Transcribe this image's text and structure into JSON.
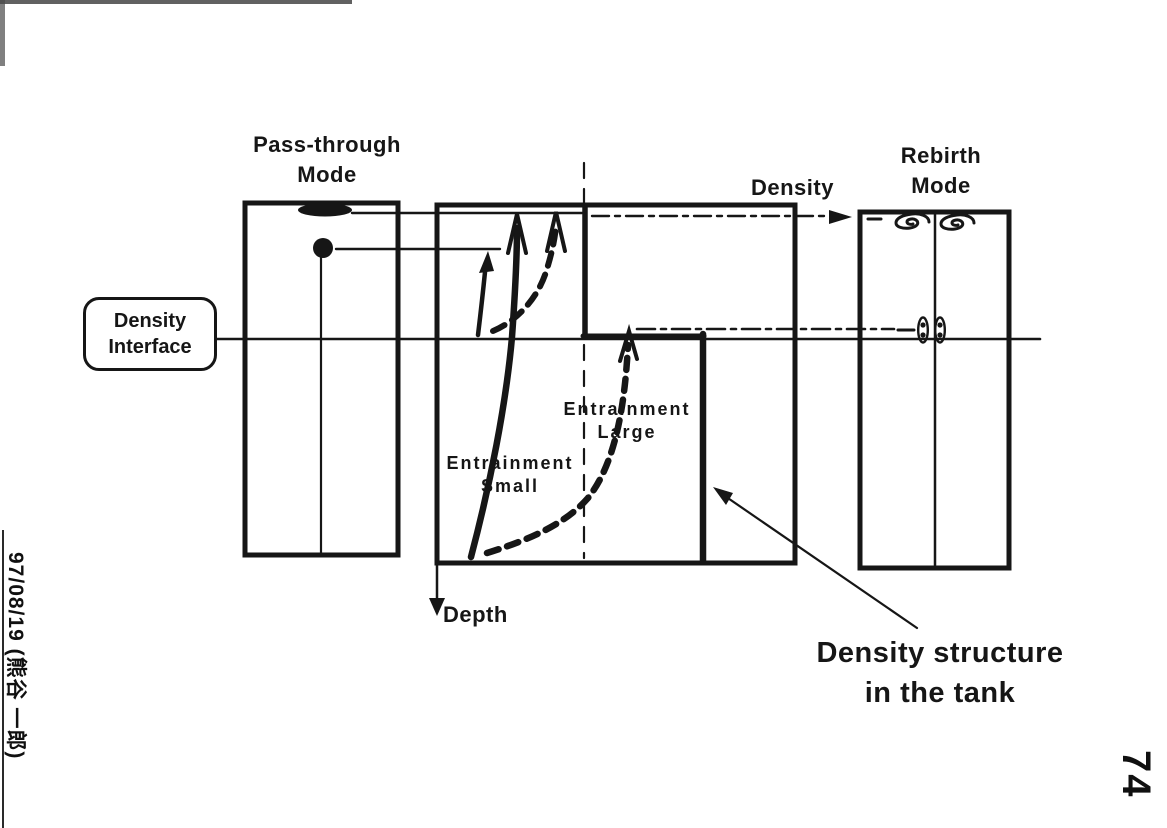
{
  "colors": {
    "ink": "#161616",
    "paper": "#ffffff"
  },
  "titles": {
    "left_tank": {
      "line1": "Pass-through",
      "line2": "Mode"
    },
    "right_tank": {
      "line1": "Rebirth",
      "line2": "Mode"
    }
  },
  "axes": {
    "density": "Density",
    "depth": "Depth"
  },
  "interface_label": {
    "line1": "Density",
    "line2": "Interface"
  },
  "annotations": {
    "entrainment_small": {
      "line1": "Entrainment",
      "line2": "Small"
    },
    "entrainment_large": {
      "line1": "Entrainment",
      "line2": "Large"
    },
    "caption": {
      "line1": "Density structure",
      "line2": "in the tank"
    }
  },
  "handwriting": {
    "date_note": "97/08/19 (熊谷 一郎)",
    "page_number": "74"
  },
  "icons": {
    "vortex": "spiral-swirl",
    "particles": "particle-pair",
    "surface_blob": "surface-intrusion-ellipse",
    "tracer": "tracer-dot"
  }
}
